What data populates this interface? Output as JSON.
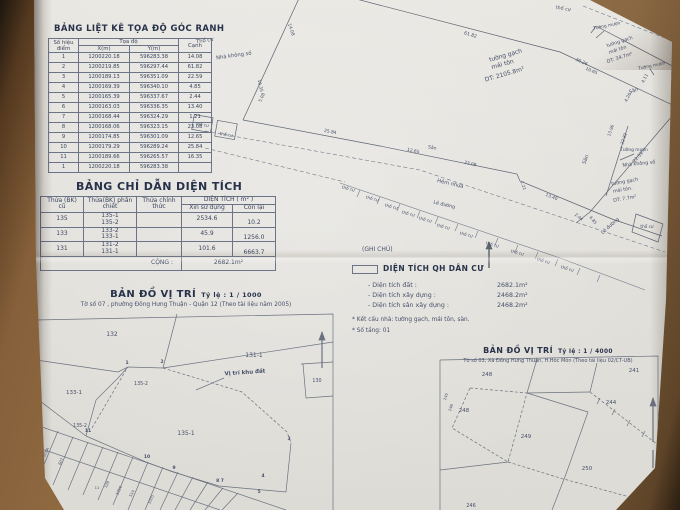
{
  "coord_table": {
    "title": "BẢNG LIỆT KÊ TỌA ĐỘ GÓC RANH",
    "headers": {
      "point": "Số hiệu điểm",
      "coords": "Tọa độ",
      "x": "X(m)",
      "y": "Y(m)",
      "edge": "Cạnh"
    },
    "rows": [
      {
        "p": "1",
        "x": "1200220.18",
        "y": "596283.38",
        "c": "14.08"
      },
      {
        "p": "2",
        "x": "1200219.85",
        "y": "596297.44",
        "c": "61.82"
      },
      {
        "p": "3",
        "x": "1200189.13",
        "y": "596351.09",
        "c": "22.59"
      },
      {
        "p": "4",
        "x": "1200169.39",
        "y": "596340.10",
        "c": "4.85"
      },
      {
        "p": "5",
        "x": "1200165.39",
        "y": "596337.67",
        "c": "2.44"
      },
      {
        "p": "6",
        "x": "1200163.03",
        "y": "596336.35",
        "c": "13.40"
      },
      {
        "p": "7",
        "x": "1200168.44",
        "y": "596324.29",
        "c": "1.21"
      },
      {
        "p": "8",
        "x": "1200168.06",
        "y": "596323.15",
        "c": "23.08"
      },
      {
        "p": "9",
        "x": "1200174.85",
        "y": "596301.09",
        "c": "12.65"
      },
      {
        "p": "10",
        "x": "1200179.29",
        "y": "596289.24",
        "c": "25.84"
      },
      {
        "p": "11",
        "x": "1200189.66",
        "y": "596265.57",
        "c": "16.35"
      },
      {
        "p": "1",
        "x": "1200220.18",
        "y": "596283.38",
        "c": ""
      }
    ]
  },
  "area_table": {
    "title": "BẢNG CHỈ DẪN DIỆN TÍCH",
    "headers": {
      "old": "Thửa (BK) cũ",
      "split": "Thửa(BK) phân chiết",
      "official": "Thửa chính thức",
      "area": "DIỆN TÍCH ( m² )",
      "use": "Xin sử dụng",
      "remain": "Còn lại"
    },
    "rows": [
      {
        "old": "135",
        "sub": "135-1\n135-2",
        "official": "",
        "use": "2534.6",
        "remain": "10.2"
      },
      {
        "old": "133",
        "sub": "133-2\n133-1",
        "official": "",
        "use": "45.9",
        "remain": "1256.0"
      },
      {
        "old": "131",
        "sub": "131-2\n131-1",
        "official": "",
        "use": "101.6",
        "remain": "6663.7"
      }
    ],
    "total_label": "CỘNG :",
    "total_value": "2682.1m²"
  },
  "legend": {
    "note_label": "(GHI CHÚ)",
    "swatch_title": "DIỆN TÍCH QH DÂN CƯ",
    "items": [
      {
        "label": "- Diện tích đất :",
        "value": "2682.1m²"
      },
      {
        "label": "- Diện tích xây dựng :",
        "value": "2468.2m²"
      },
      {
        "label": "- Diện tích sân xây dựng :",
        "value": "2468.2m²"
      }
    ],
    "notes": [
      "* Kết cấu nhà:  tường gạch, mái tôn, sàn.",
      "* Số tầng: 01"
    ]
  },
  "map1": {
    "title": "BẢN ĐỒ VỊ TRÍ",
    "scale_label": "Tỷ lệ :  1 / 1000",
    "subtitle": "Tờ số 07 , phường Đông Hưng Thuận - Quận 12  (Theo tài liệu năm 2005)"
  },
  "map2": {
    "title": "BẢN ĐỒ VỊ TRÍ",
    "scale_label": "Tỷ lệ :  1 / 4000",
    "subtitle": "Tờ số 03, Xã Đông Hưng Thuận, H.Hóc Môn (Theo tài liệu 02/CT-UB)"
  },
  "drawing": {
    "labels": [
      {
        "t": "Thổ cư",
        "x": 205,
        "y": 42,
        "r": -8
      },
      {
        "t": "Nhà không số",
        "x": 234,
        "y": 57,
        "r": -8
      },
      {
        "t": "thổ cư",
        "x": 563,
        "y": 10,
        "r": 10,
        "s": 4.8
      },
      {
        "t": "tường gạch",
        "x": 506,
        "y": 57,
        "r": -16,
        "s": 6
      },
      {
        "t": "mái tôn",
        "x": 503,
        "y": 66,
        "r": -16,
        "s": 6
      },
      {
        "t": "DT: 2105.8m²",
        "x": 505,
        "y": 76,
        "r": -16,
        "s": 6
      },
      {
        "t": "Tường mượn",
        "x": 607,
        "y": 27,
        "r": -12,
        "s": 4.4
      },
      {
        "t": "tường gạch",
        "x": 620,
        "y": 43,
        "r": -18,
        "s": 4.8
      },
      {
        "t": "mái tôn",
        "x": 618,
        "y": 51,
        "r": -18,
        "s": 4.8
      },
      {
        "t": "DT: 34.7m²",
        "x": 620,
        "y": 59,
        "r": -18,
        "s": 4.8
      },
      {
        "t": "Tường mượn",
        "x": 652,
        "y": 67,
        "r": -12,
        "s": 4.4
      },
      {
        "t": "Sân",
        "x": 634,
        "y": 92,
        "r": -20,
        "s": 5
      },
      {
        "t": "30.26",
        "x": 581,
        "y": 63,
        "r": 24,
        "s": 4.4
      },
      {
        "t": "10.65",
        "x": 591,
        "y": 72,
        "r": 24,
        "s": 4.4
      },
      {
        "t": "4.11",
        "x": 646,
        "y": 79,
        "r": -62,
        "s": 4.4
      },
      {
        "t": "4.26",
        "x": 629,
        "y": 98,
        "r": -62,
        "s": 4.4
      },
      {
        "t": "61.82",
        "x": 470,
        "y": 36,
        "r": 17,
        "s": 4.6
      },
      {
        "t": "14.08",
        "x": 290,
        "y": 30,
        "r": 72,
        "s": 4.4
      },
      {
        "t": "16.35",
        "x": 259,
        "y": 86,
        "r": 78,
        "s": 4.4
      },
      {
        "t": "5.08",
        "x": 263,
        "y": 98,
        "r": -65,
        "s": 4.2
      },
      {
        "t": "25.84",
        "x": 330,
        "y": 133,
        "r": 11,
        "s": 4.4
      },
      {
        "t": "12.65",
        "x": 413,
        "y": 152,
        "r": 12,
        "s": 4.4
      },
      {
        "t": "23.08",
        "x": 470,
        "y": 165,
        "r": 13,
        "s": 4.4
      },
      {
        "t": "1.21",
        "x": 522,
        "y": 186,
        "r": 70,
        "s": 4.2
      },
      {
        "t": "13.40",
        "x": 551,
        "y": 198,
        "r": 22,
        "s": 4.4
      },
      {
        "t": "2.44",
        "x": 578,
        "y": 218,
        "r": 40,
        "s": 4.2
      },
      {
        "t": "4.85",
        "x": 592,
        "y": 221,
        "r": 50,
        "s": 4.2
      },
      {
        "t": "22.59",
        "x": 639,
        "y": 158,
        "r": -49,
        "s": 4.6
      },
      {
        "t": "13.96",
        "x": 612,
        "y": 131,
        "r": -70,
        "s": 4.2
      },
      {
        "t": "22.82",
        "x": 625,
        "y": 139,
        "r": -70,
        "s": 4.2
      },
      {
        "t": "Tường mượn",
        "x": 634,
        "y": 151,
        "r": 0,
        "s": 4.4
      },
      {
        "t": "Nhà không số",
        "x": 639,
        "y": 165,
        "r": -6,
        "s": 4.8
      },
      {
        "t": "tường gạch",
        "x": 625,
        "y": 183,
        "r": -10,
        "s": 4.8
      },
      {
        "t": "mái tôn.",
        "x": 623,
        "y": 191,
        "r": -10,
        "s": 4.8
      },
      {
        "t": "DT: 7.7m²",
        "x": 625,
        "y": 200,
        "r": -10,
        "s": 4.8
      },
      {
        "t": "Sân",
        "x": 587,
        "y": 160,
        "r": -70,
        "s": 5
      },
      {
        "t": "Sân",
        "x": 432,
        "y": 149,
        "r": 12,
        "s": 4.6
      },
      {
        "t": "Hẻm nhựa",
        "x": 450,
        "y": 185,
        "r": 13,
        "s": 5.2
      },
      {
        "t": "Lề đường",
        "x": 444,
        "y": 206,
        "r": 13,
        "s": 4.8
      },
      {
        "t": "Lề đường",
        "x": 611,
        "y": 227,
        "r": -42,
        "s": 4.8
      },
      {
        "t": "thổ cư",
        "x": 348,
        "y": 190,
        "r": 14,
        "s": 4.2
      },
      {
        "t": "thổ cư",
        "x": 372,
        "y": 200,
        "r": 14,
        "s": 4.2
      },
      {
        "t": "thổ cư",
        "x": 391,
        "y": 208,
        "r": 14,
        "s": 4.2
      },
      {
        "t": "thổ cư",
        "x": 408,
        "y": 215,
        "r": 14,
        "s": 4.2
      },
      {
        "t": "thổ cư",
        "x": 425,
        "y": 221,
        "r": 14,
        "s": 4.2
      },
      {
        "t": "thổ cư",
        "x": 443,
        "y": 228,
        "r": 14,
        "s": 4.2
      },
      {
        "t": "thổ cư",
        "x": 466,
        "y": 236,
        "r": 14,
        "s": 4.2
      },
      {
        "t": "thổ cư",
        "x": 492,
        "y": 246,
        "r": 14,
        "s": 4.2
      },
      {
        "t": "thổ cư",
        "x": 517,
        "y": 254,
        "r": 14,
        "s": 4.2
      },
      {
        "t": "thổ cư",
        "x": 543,
        "y": 262,
        "r": 16,
        "s": 4.2
      },
      {
        "t": "thổ cư",
        "x": 567,
        "y": 270,
        "r": 16,
        "s": 4.2
      },
      {
        "t": "thổ cư",
        "x": 647,
        "y": 228,
        "r": 0,
        "s": 4.2
      },
      {
        "t": "thổ cư",
        "x": 202,
        "y": 126,
        "r": 10,
        "s": 4.2
      },
      {
        "t": "thổ cư",
        "x": 226,
        "y": 136,
        "r": 10,
        "s": 4.2
      },
      {
        "t": "132",
        "x": 112,
        "y": 336,
        "s": 6
      },
      {
        "t": "131-1",
        "x": 254,
        "y": 357,
        "s": 6
      },
      {
        "t": "133-1",
        "x": 74,
        "y": 394,
        "s": 5.5
      },
      {
        "t": "135-2",
        "x": 141,
        "y": 385,
        "s": 4.8
      },
      {
        "t": "135-2",
        "x": 80,
        "y": 427,
        "s": 4.8
      },
      {
        "t": "135-1",
        "x": 186,
        "y": 435,
        "s": 6
      },
      {
        "t": "130",
        "x": 317,
        "y": 382,
        "s": 4.8
      },
      {
        "t": "Vị trí khu đất",
        "x": 245,
        "y": 374,
        "r": -4,
        "s": 5.5,
        "w": "bold"
      },
      {
        "t": "1",
        "x": 127,
        "y": 364,
        "s": 4.5,
        "w": "bold"
      },
      {
        "t": "2",
        "x": 162,
        "y": 363,
        "s": 4.5,
        "w": "bold"
      },
      {
        "t": "11",
        "x": 88,
        "y": 432,
        "s": 4.5,
        "w": "bold"
      },
      {
        "t": "10",
        "x": 147,
        "y": 458,
        "s": 4.5,
        "w": "bold"
      },
      {
        "t": "9",
        "x": 174,
        "y": 469,
        "s": 4.5,
        "w": "bold"
      },
      {
        "t": "8 7",
        "x": 220,
        "y": 482,
        "s": 4.5,
        "w": "bold"
      },
      {
        "t": "4",
        "x": 263,
        "y": 477,
        "s": 4.5,
        "w": "bold"
      },
      {
        "t": "5",
        "x": 259,
        "y": 493,
        "s": 4.5,
        "w": "bold"
      },
      {
        "t": "3",
        "x": 289,
        "y": 440,
        "s": 4.5,
        "w": "bold"
      },
      {
        "t": "605A",
        "x": 47,
        "y": 453,
        "r": -65,
        "s": 3.8
      },
      {
        "t": "607",
        "x": 62,
        "y": 462,
        "r": -65,
        "s": 3.8
      },
      {
        "t": "11",
        "x": 97,
        "y": 489,
        "r": 0,
        "s": 3.8
      },
      {
        "t": "128",
        "x": 108,
        "y": 485,
        "r": -65,
        "s": 3.8
      },
      {
        "t": "1056",
        "x": 120,
        "y": 491,
        "r": -65,
        "s": 3.8
      },
      {
        "t": "514",
        "x": 133,
        "y": 494,
        "r": -65,
        "s": 3.8
      },
      {
        "t": "1005",
        "x": 152,
        "y": 500,
        "r": -65,
        "s": 3.8
      },
      {
        "t": "248",
        "x": 487,
        "y": 376,
        "s": 5.5
      },
      {
        "t": "241",
        "x": 634,
        "y": 372,
        "s": 5.5
      },
      {
        "t": "248",
        "x": 464,
        "y": 412,
        "s": 5.5
      },
      {
        "t": "249",
        "x": 526,
        "y": 438,
        "s": 5.5
      },
      {
        "t": "244",
        "x": 611,
        "y": 404,
        "s": 5.5
      },
      {
        "t": "250",
        "x": 587,
        "y": 470,
        "s": 5.5
      },
      {
        "t": "251",
        "x": 641,
        "y": 504,
        "s": 5
      },
      {
        "t": "246",
        "x": 471,
        "y": 507,
        "s": 5
      },
      {
        "t": "245",
        "x": 447,
        "y": 397,
        "r": -72,
        "s": 3.8
      },
      {
        "t": "246",
        "x": 452,
        "y": 408,
        "r": -72,
        "s": 3.8
      }
    ]
  }
}
